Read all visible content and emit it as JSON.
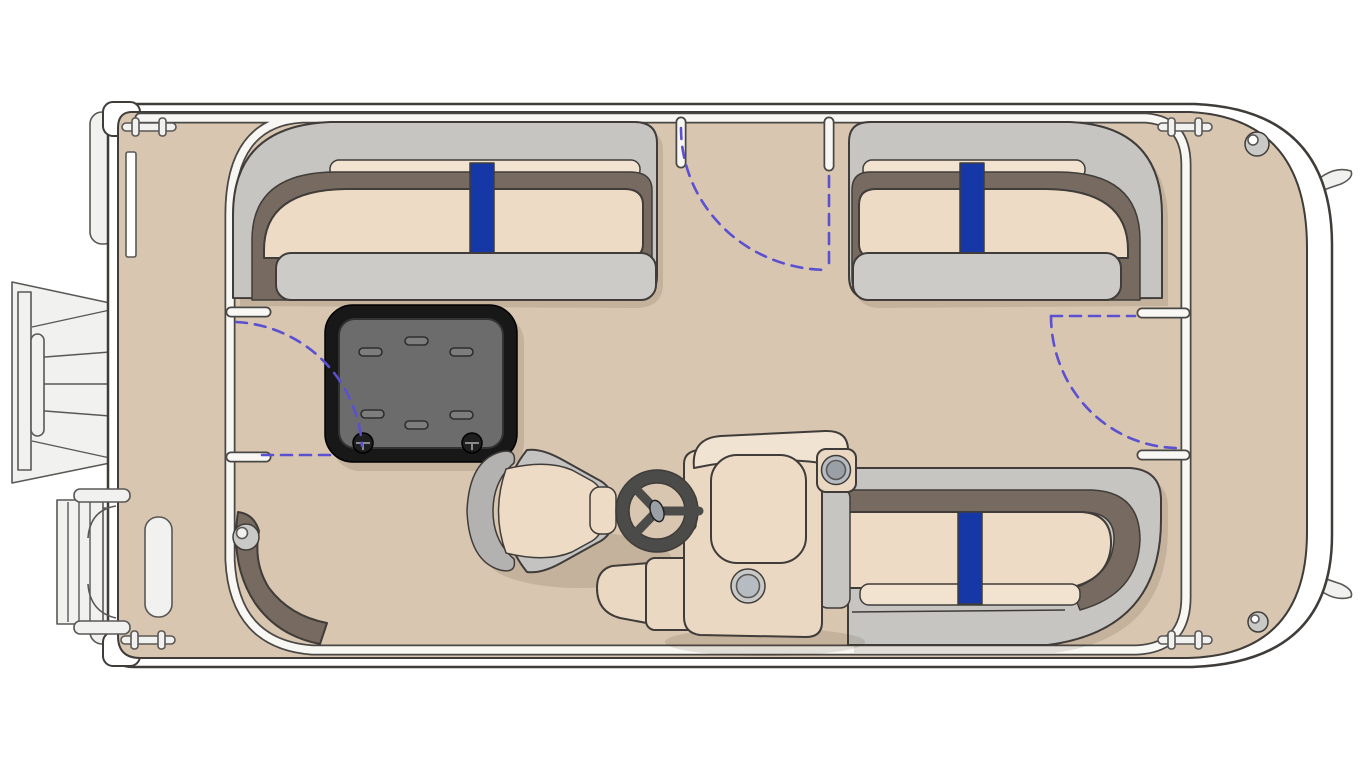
{
  "title": "Pontoon boat floor plan — top-down deck layout diagram",
  "colors": {
    "line": "#3f3c39",
    "hull_white": "#ffffff",
    "floor_tan": "#d8c6b1",
    "rail_white": "#f8f7f4",
    "rail_stroke": "#4a4845",
    "seat_grey": "#c6c5c1",
    "seat_grey_light": "#cccbc7",
    "cushion_tan": "#eedbc6",
    "cushion_light": "#f2e3d0",
    "trim_brown": "#776a60",
    "accent_blue": "#1638a6",
    "gate_swing": "#5a50d0",
    "hatch_black": "#181818",
    "hatch_panel": "#6c6c6c",
    "hatch_slot": "#7d7d7d",
    "screw_dark": "#1f1f1f",
    "console_tan": "#ead8c2",
    "console_light": "#f0e3d1",
    "metal_grey": "#b6bcc1",
    "metal_dark": "#9aa0a6",
    "wheel_dark": "#4b4b49",
    "chair_grey": "#c4c3c1",
    "chair_shade": "#b3b2b0",
    "exterior_grey": "#f1f1f0",
    "ext_stroke": "#5a5856",
    "light_grey": "#c9c9c8"
  },
  "components": {
    "hull": "pontoon deck hull outline",
    "bow_deck": "open bow deck (right)",
    "stern_platform": "stern platform (left)",
    "port_aft_lounge": "port aft lounge with blue stripe cushion",
    "port_bow_lounge": "port bow lounge with blue stripe cushion",
    "starboard_bow_lounge": "starboard bow lounge with blue stripe cushion",
    "storage_hatch": "in-floor storage hatch with vent slots",
    "captains_chair": "captain's swivel chair",
    "helm_console": "helm console with windscreen, cup holders and throttle",
    "steering_wheel": "three-spoke steering wheel",
    "port_side_gate": "port side boarding gate with swing arc",
    "stern_gate": "stern gate with swing arc",
    "bow_gate": "bow gate with swing arc",
    "outboard_motor": "outboard motor at stern",
    "boarding_ladder": "stern boarding ladder",
    "cleats": "four mooring cleats",
    "nav_lights": "bow deck lights",
    "aft_corner_step": "aft corner step with courtesy light",
    "pontoon_fins": "pontoon bow spray fins",
    "pontoon_sterns": "pontoon tube stern ends"
  }
}
